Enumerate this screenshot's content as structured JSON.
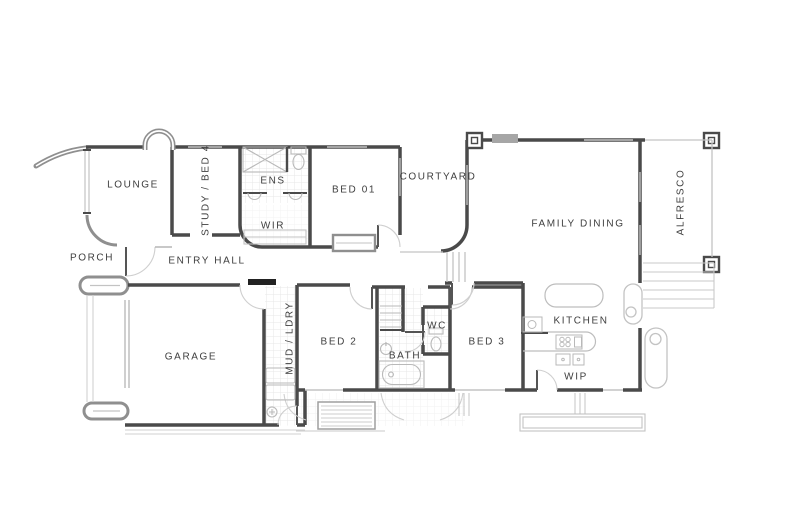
{
  "page": {
    "background": "#ffffff",
    "type": "architectural floor plan"
  },
  "colors": {
    "wall_dark": "#4a4a4a",
    "wall_mid": "#8f8f8f",
    "line_light": "#c3c3c3",
    "tile_grid": "#e4e4e4",
    "text": "#3e3e3e",
    "door_leaf_black": "#222222",
    "bbq_fill": "#a6a6a6"
  },
  "rooms": [
    {
      "id": "lounge",
      "label": "LOUNGE"
    },
    {
      "id": "study-bed4",
      "label": "STUDY / BED 4"
    },
    {
      "id": "ens",
      "label": "ENS"
    },
    {
      "id": "wir",
      "label": "WIR"
    },
    {
      "id": "bed01",
      "label": "BED 01"
    },
    {
      "id": "courtyard",
      "label": "COURTYARD"
    },
    {
      "id": "family-dining",
      "label": "FAMILY DINING"
    },
    {
      "id": "alfresco",
      "label": "ALFRESCO"
    },
    {
      "id": "porch",
      "label": "PORCH"
    },
    {
      "id": "entry-hall",
      "label": "ENTRY HALL"
    },
    {
      "id": "garage",
      "label": "GARAGE"
    },
    {
      "id": "mud-ldry",
      "label": "MUD / LDRY"
    },
    {
      "id": "bed2",
      "label": "BED 2"
    },
    {
      "id": "bath",
      "label": "BATH"
    },
    {
      "id": "wc",
      "label": "WC"
    },
    {
      "id": "bed3",
      "label": "BED 3"
    },
    {
      "id": "kitchen",
      "label": "KITCHEN"
    },
    {
      "id": "wip",
      "label": "WIP"
    }
  ],
  "fixtures": [
    "shower",
    "toilet",
    "twin-vanity-basins",
    "bathtub",
    "bath-vanity",
    "kitchen-island",
    "kitchen-bench",
    "cooktop",
    "pantry-shelves",
    "laundry-appliances",
    "laundry-tub",
    "linen-shelves",
    "wardrobe-shelf",
    "window-seat",
    "bbq",
    "water-tank",
    "columns",
    "steps",
    "garage-door",
    "piers",
    "planter",
    "deck-grille",
    "feature-arch",
    "curved-blade-wall"
  ]
}
